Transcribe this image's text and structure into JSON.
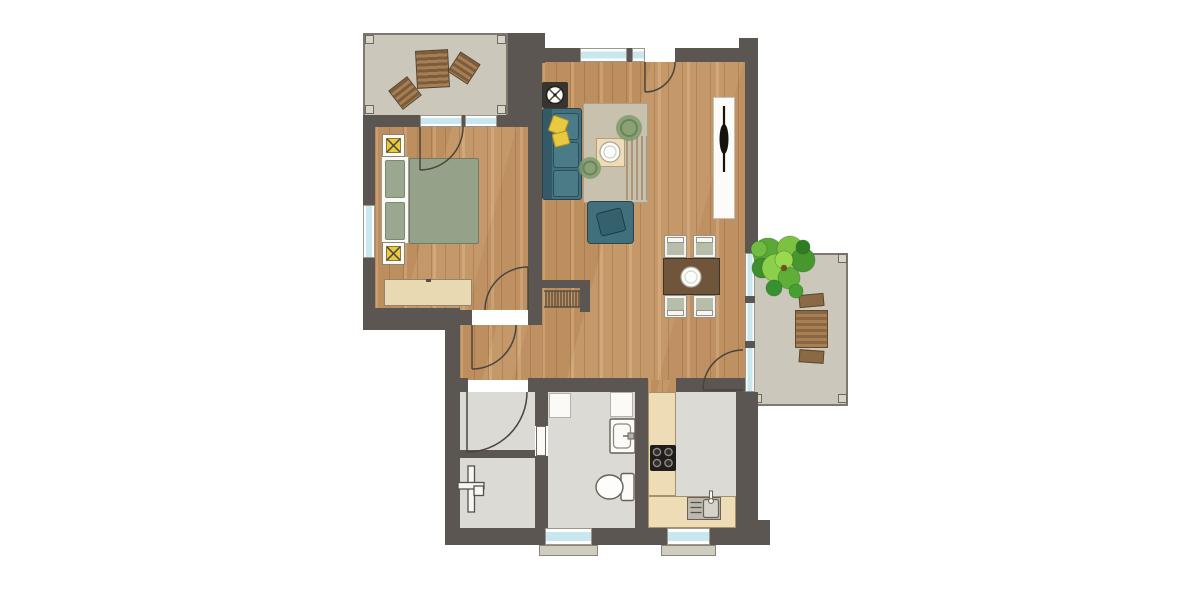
{
  "document": {
    "type": "architectural-floor-plan",
    "visible_text": [],
    "description": "Top-down furnished apartment floor plan: balcony with loungers (top-left), bedroom, living room with sofa and TV, dining area, hallway, utility room, bathroom, kitchen, and a right-side terrace with tree and picnic table"
  },
  "palette": {
    "wall": "#5b5651",
    "wood": "#c59869",
    "tile": "#dcdad4",
    "deck": "#cbc7ba",
    "deck-border": "#7d7970",
    "glass": "#c9e7ee",
    "sill": "#cfccc0",
    "counter": "#eddcb5",
    "sideboard": "#e9d9b3",
    "sofa": "#416f7b",
    "cushion": "#4b7b87",
    "pillow": "#e9c93f",
    "bed": "#95a289",
    "rug": "#c8c1ad",
    "rug-plant": "#7f9b6b",
    "table-brown": "#6f5539",
    "chair-seat": "#b6bda9",
    "picnic": "#9b7549",
    "tv": "#15130e",
    "stove-body": "#38342f",
    "tree-greens": [
      "#5aa838",
      "#7cc142",
      "#47962e",
      "#8ccf4a",
      "#3e8f2c",
      "#5fae37",
      "#2e7d25",
      "#6fbc41",
      "#379031",
      "#46a02f",
      "#9ad84f"
    ],
    "tree-trunk": "#7a4e22"
  },
  "rooms": [
    {
      "name": "balcony-top-left",
      "floor": "deck",
      "furniture": [
        "sun-lounger",
        "side-chair",
        "side-chair"
      ]
    },
    {
      "name": "bedroom",
      "floor": "wood",
      "furniture": [
        "double-bed",
        "headboard",
        "nightstand-lamp",
        "nightstand-lamp",
        "sideboard"
      ],
      "openings": [
        "balcony-door",
        "entry-door",
        "window-left",
        "window-top"
      ]
    },
    {
      "name": "living-room",
      "floor": "wood",
      "furniture": [
        "wood-stove",
        "sofa",
        "throw-pillow",
        "throw-pillow",
        "rug",
        "coffee-table",
        "armchair",
        "tv-lowboard",
        "tv"
      ],
      "openings": [
        "entrance-door",
        "window-top"
      ]
    },
    {
      "name": "dining-area",
      "floor": "wood",
      "furniture": [
        "dining-table",
        "dining-chair",
        "dining-chair",
        "dining-chair",
        "dining-chair"
      ],
      "openings": [
        "terrace-door",
        "glazed-wall"
      ]
    },
    {
      "name": "hallway",
      "floor": "wood",
      "furniture": [
        "radiator-niche"
      ]
    },
    {
      "name": "utility-room",
      "floor": "tile",
      "furniture": [
        "towel-radiator"
      ],
      "openings": [
        "hall-door",
        "bathroom-door"
      ]
    },
    {
      "name": "bathroom",
      "floor": "tile",
      "furniture": [
        "appliance-block",
        "appliance-block",
        "washbasin",
        "toilet"
      ],
      "openings": [
        "window-bottom"
      ]
    },
    {
      "name": "kitchen",
      "floor": "tile",
      "furniture": [
        "counter-l-shape",
        "cooktop",
        "sink-unit"
      ],
      "openings": [
        "window-bottom"
      ]
    },
    {
      "name": "terrace-right",
      "floor": "deck",
      "furniture": [
        "tree",
        "picnic-table",
        "bench",
        "bench"
      ]
    }
  ]
}
